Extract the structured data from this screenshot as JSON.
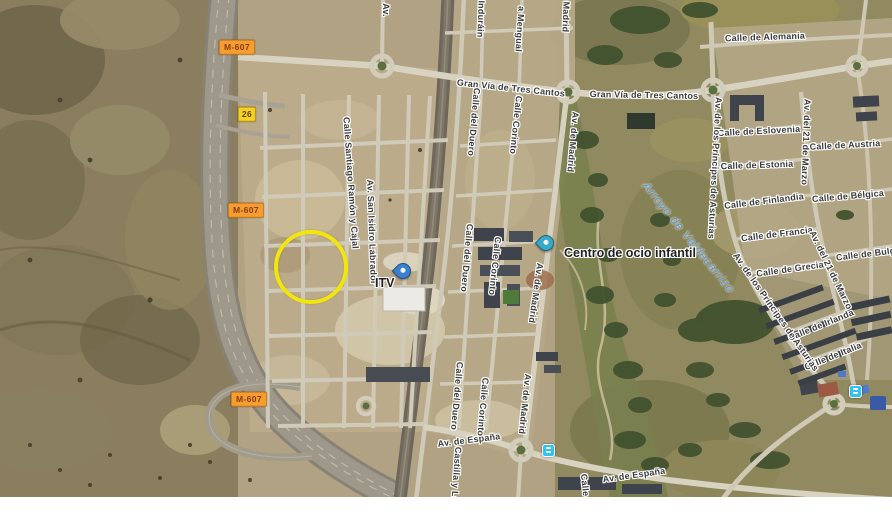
{
  "map": {
    "kind": "satellite",
    "area_description": "Nuevo Tres Cantos / M-607, Madrid",
    "colors": {
      "road_shield_bg": "#f59d31",
      "road_shield_text": "#8a3c10",
      "exit_shield_bg": "#f8d022",
      "water_label": "#5b95c9",
      "highlight_circle": "#f2e50b",
      "transit_icon": "#2fc3f0",
      "poi_pin_teal": "#35aacb",
      "poi_pin_blue": "#3a7fd0"
    },
    "shields": [
      {
        "label": "M-607",
        "cx": 237,
        "cy": 47,
        "kind": "road"
      },
      {
        "label": "26",
        "cx": 247,
        "cy": 114,
        "kind": "exit"
      },
      {
        "label": "M-607",
        "cx": 246,
        "cy": 210,
        "kind": "road"
      },
      {
        "label": "M-607",
        "cx": 249,
        "cy": 399,
        "kind": "road"
      }
    ],
    "street_labels": [
      {
        "t": "Calle de Alemania",
        "x": 765,
        "y": 37,
        "r": -2
      },
      {
        "t": "Gran Vía de Tres Cantos",
        "x": 511,
        "y": 88,
        "r": 6
      },
      {
        "t": "Gran Vía de Tres Cantos",
        "x": 644,
        "y": 95,
        "r": 1
      },
      {
        "t": "Calle de Eslovenia",
        "x": 759,
        "y": 131,
        "r": -3
      },
      {
        "t": "Calle de Austria",
        "x": 845,
        "y": 145,
        "r": -3
      },
      {
        "t": "Calle de Estonia",
        "x": 757,
        "y": 165,
        "r": -2
      },
      {
        "t": "Calle de Finlandia",
        "x": 764,
        "y": 201,
        "r": -7
      },
      {
        "t": "Calle de Bélgica",
        "x": 848,
        "y": 196,
        "r": -5
      },
      {
        "t": "Calle de Francia",
        "x": 777,
        "y": 234,
        "r": -7
      },
      {
        "t": "Calle de Bulgaria",
        "x": 874,
        "y": 253,
        "r": -7
      },
      {
        "t": "Calle de Grecia",
        "x": 790,
        "y": 269,
        "r": -8
      },
      {
        "t": "Calle de Irlanda",
        "x": 821,
        "y": 325,
        "r": -22
      },
      {
        "t": "Calle de Italia",
        "x": 833,
        "y": 356,
        "r": -22
      },
      {
        "t": "Av. de España",
        "x": 469,
        "y": 440,
        "r": -7
      },
      {
        "t": "Av. de España",
        "x": 634,
        "y": 475,
        "r": -8
      },
      {
        "t": "Calle Santiago Ramón y Cajal",
        "x": 351,
        "y": 183,
        "r": 86
      },
      {
        "t": "Av. San Isidro Labrador",
        "x": 372,
        "y": 232,
        "r": 88
      },
      {
        "t": "Calle del Duero",
        "x": 474,
        "y": 122,
        "r": 95
      },
      {
        "t": "Calle del Duero",
        "x": 467,
        "y": 258,
        "r": 95
      },
      {
        "t": "Calle del Duero",
        "x": 457,
        "y": 396,
        "r": 95
      },
      {
        "t": "Calle Corinto",
        "x": 516,
        "y": 125,
        "r": 96
      },
      {
        "t": "Calle Corinto",
        "x": 495,
        "y": 266,
        "r": 96
      },
      {
        "t": "Calle Corinto",
        "x": 483,
        "y": 407,
        "r": 95
      },
      {
        "t": "Madrid",
        "x": 566,
        "y": 17,
        "r": 92
      },
      {
        "t": "Av. de Madrid",
        "x": 573,
        "y": 142,
        "r": 95
      },
      {
        "t": "Av. de Madrid",
        "x": 536,
        "y": 293,
        "r": 98
      },
      {
        "t": "Av. de Madrid",
        "x": 525,
        "y": 404,
        "r": 96
      },
      {
        "t": "Av. de los Príncipes de Asturias",
        "x": 715,
        "y": 168,
        "r": 93
      },
      {
        "t": "Av. de los Príncipes de Asturias",
        "x": 776,
        "y": 312,
        "r": 55
      },
      {
        "t": "Av. del 21 de Marzo",
        "x": 806,
        "y": 142,
        "r": 92
      },
      {
        "t": "Av. del 21 de Marzo",
        "x": 831,
        "y": 270,
        "r": 64
      },
      {
        "t": "Induráin",
        "x": 481,
        "y": 19,
        "r": 92
      },
      {
        "t": "a Mengual",
        "x": 520,
        "y": 29,
        "r": 94
      },
      {
        "t": "Av.",
        "x": 386,
        "y": 10,
        "r": 90
      },
      {
        "t": "Castilla y León",
        "x": 456,
        "y": 480,
        "r": 94
      },
      {
        "t": "Calle",
        "x": 585,
        "y": 485,
        "r": 84
      }
    ],
    "water_labels": [
      {
        "t": "Arroyo de Valdecarrizo",
        "x": 688,
        "y": 238,
        "r": 51
      }
    ],
    "pois": [
      {
        "name": "Centro de ocio infantil",
        "pin_x": 545,
        "pin_y": 252,
        "label_x": 564,
        "label_y": 246,
        "pin_color": "#35aacb"
      },
      {
        "name": "ITV",
        "pin_x": 402,
        "pin_y": 280,
        "label_x": 375,
        "label_y": 276,
        "pin_color": "#3a7fd0"
      }
    ],
    "transit_stops": [
      {
        "x": 548,
        "y": 450
      },
      {
        "x": 855,
        "y": 391
      }
    ],
    "annotation_circle": {
      "cx": 311,
      "cy": 267,
      "r": 33,
      "color": "#f2e50b"
    }
  }
}
